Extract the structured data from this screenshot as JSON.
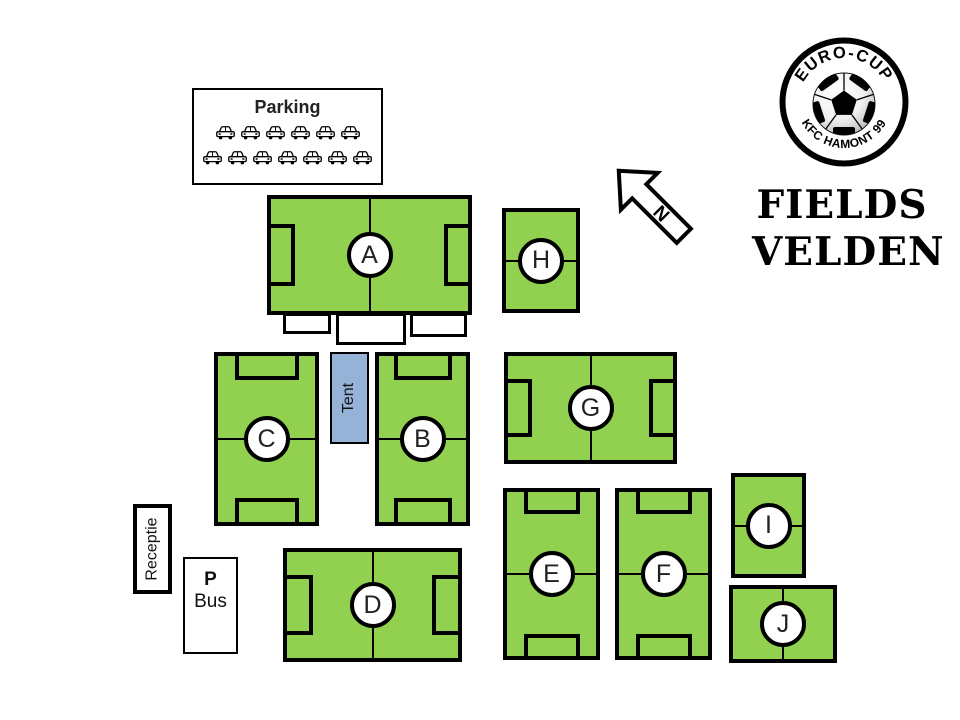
{
  "logo": {
    "arc_top": "EURO-CUP",
    "arc_bottom": "KFC HAMONT 99"
  },
  "title": {
    "line1": "FIELDS",
    "line2": "VELDEN"
  },
  "compass": {
    "label": "N"
  },
  "parking": {
    "label": "Parking",
    "car_rows": [
      6,
      7
    ]
  },
  "tent": {
    "label": "Tent"
  },
  "reception": {
    "label": "Receptie"
  },
  "bus_area": {
    "line1": "P",
    "line2": "Bus"
  },
  "fields": [
    {
      "id": "A",
      "label": "A"
    },
    {
      "id": "B",
      "label": "B"
    },
    {
      "id": "C",
      "label": "C"
    },
    {
      "id": "D",
      "label": "D"
    },
    {
      "id": "E",
      "label": "E"
    },
    {
      "id": "F",
      "label": "F"
    },
    {
      "id": "G",
      "label": "G"
    },
    {
      "id": "H",
      "label": "H"
    },
    {
      "id": "I",
      "label": "I"
    },
    {
      "id": "J",
      "label": "J"
    }
  ],
  "icons": {
    "car": "car-icon",
    "north_arrow": "north-arrow-icon",
    "soccer_ball": "soccer-ball-icon"
  },
  "colors": {
    "field_green": "#92D050",
    "tent_blue": "#95B3D7",
    "outline": "#000000",
    "background": "#FFFFFF"
  }
}
